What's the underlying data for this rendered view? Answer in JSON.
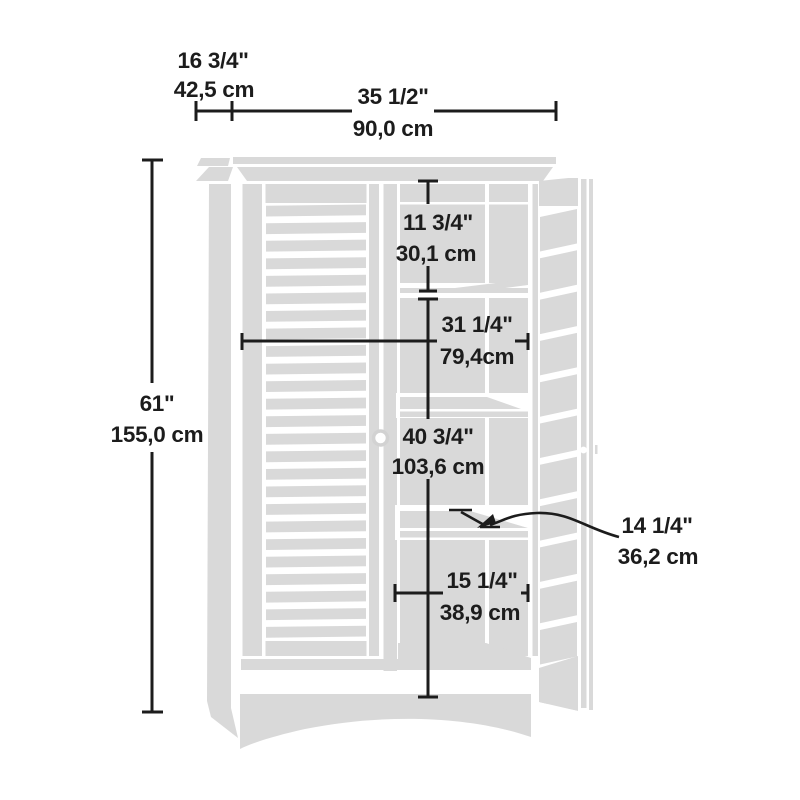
{
  "title": "Storage cabinet dimension diagram",
  "colors": {
    "cabinet_fill": "#d9d9d9",
    "line": "#1c1c1c",
    "text": "#1c1c1c",
    "background": "#ffffff"
  },
  "dimensions": {
    "depth": {
      "imperial": "16 3/4\"",
      "metric": "42,5 cm"
    },
    "width": {
      "imperial": "35 1/2\"",
      "metric": "90,0 cm"
    },
    "height": {
      "imperial": "61\"",
      "metric": "155,0 cm"
    },
    "upper_compartment": {
      "imperial": "11 3/4\"",
      "metric": "30,1 cm"
    },
    "interior_width": {
      "imperial": "31 1/4\"",
      "metric": "79,4cm"
    },
    "lower_compartment": {
      "imperial": "40 3/4\"",
      "metric": "103,6 cm"
    },
    "shelf_depth": {
      "imperial": "14 1/4\"",
      "metric": "36,2 cm"
    },
    "bottom_compartment": {
      "imperial": "15 1/4\"",
      "metric": "38,9 cm"
    }
  }
}
